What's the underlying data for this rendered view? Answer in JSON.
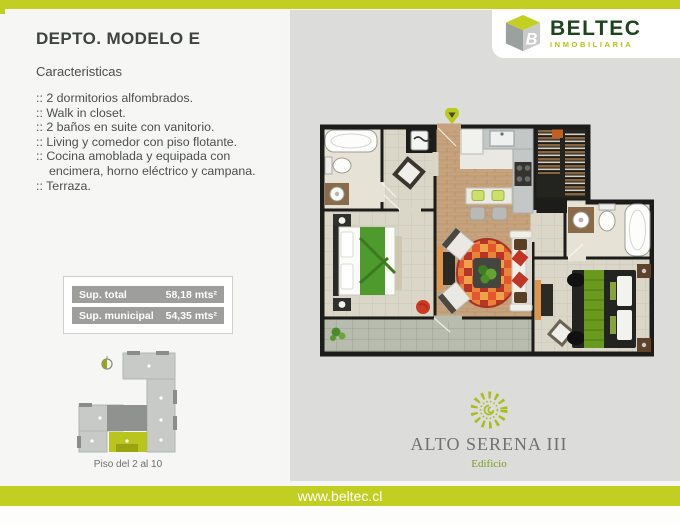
{
  "left_panel": {
    "title": "DEPTO. MODELO E",
    "subtitle": "Caracteristicas",
    "features": [
      ":: 2 dormitorios alfombrados.",
      ":: Walk in closet.",
      ":: 2 baños en suite con vanitorio.",
      ":: Living y comedor con piso flotante.",
      ":: Cocina amoblada y equipada con encimera, horno eléctrico y campana.",
      ":: Terraza."
    ],
    "surfaces": [
      {
        "label": "Sup. total",
        "value": "58,18 mts²"
      },
      {
        "label": "Sup. municipal",
        "value": "54,35 mts²"
      }
    ],
    "keyplan_caption": "Piso del 2 al 10"
  },
  "brand": {
    "name": "BELTEC",
    "tagline": "INMOBILIARIA",
    "logo_letter": "B"
  },
  "project": {
    "name": "ALTO SERENA III",
    "type": "Edificio"
  },
  "footer": {
    "url": "www.beltec.cl"
  },
  "icons": {
    "pin": "location-pin-icon",
    "compass": "north-compass-icon",
    "sun": "sun-icon",
    "cube": "beltec-cube-icon"
  },
  "colors": {
    "accent_lime": "#c2ce21",
    "panel_gray": "#dcdcda",
    "brand_green": "#1e441f",
    "brand_lime": "#b4c40a",
    "row_gray": "#9e9e9d",
    "keyplan_unit_lime": "#b9c41c"
  }
}
